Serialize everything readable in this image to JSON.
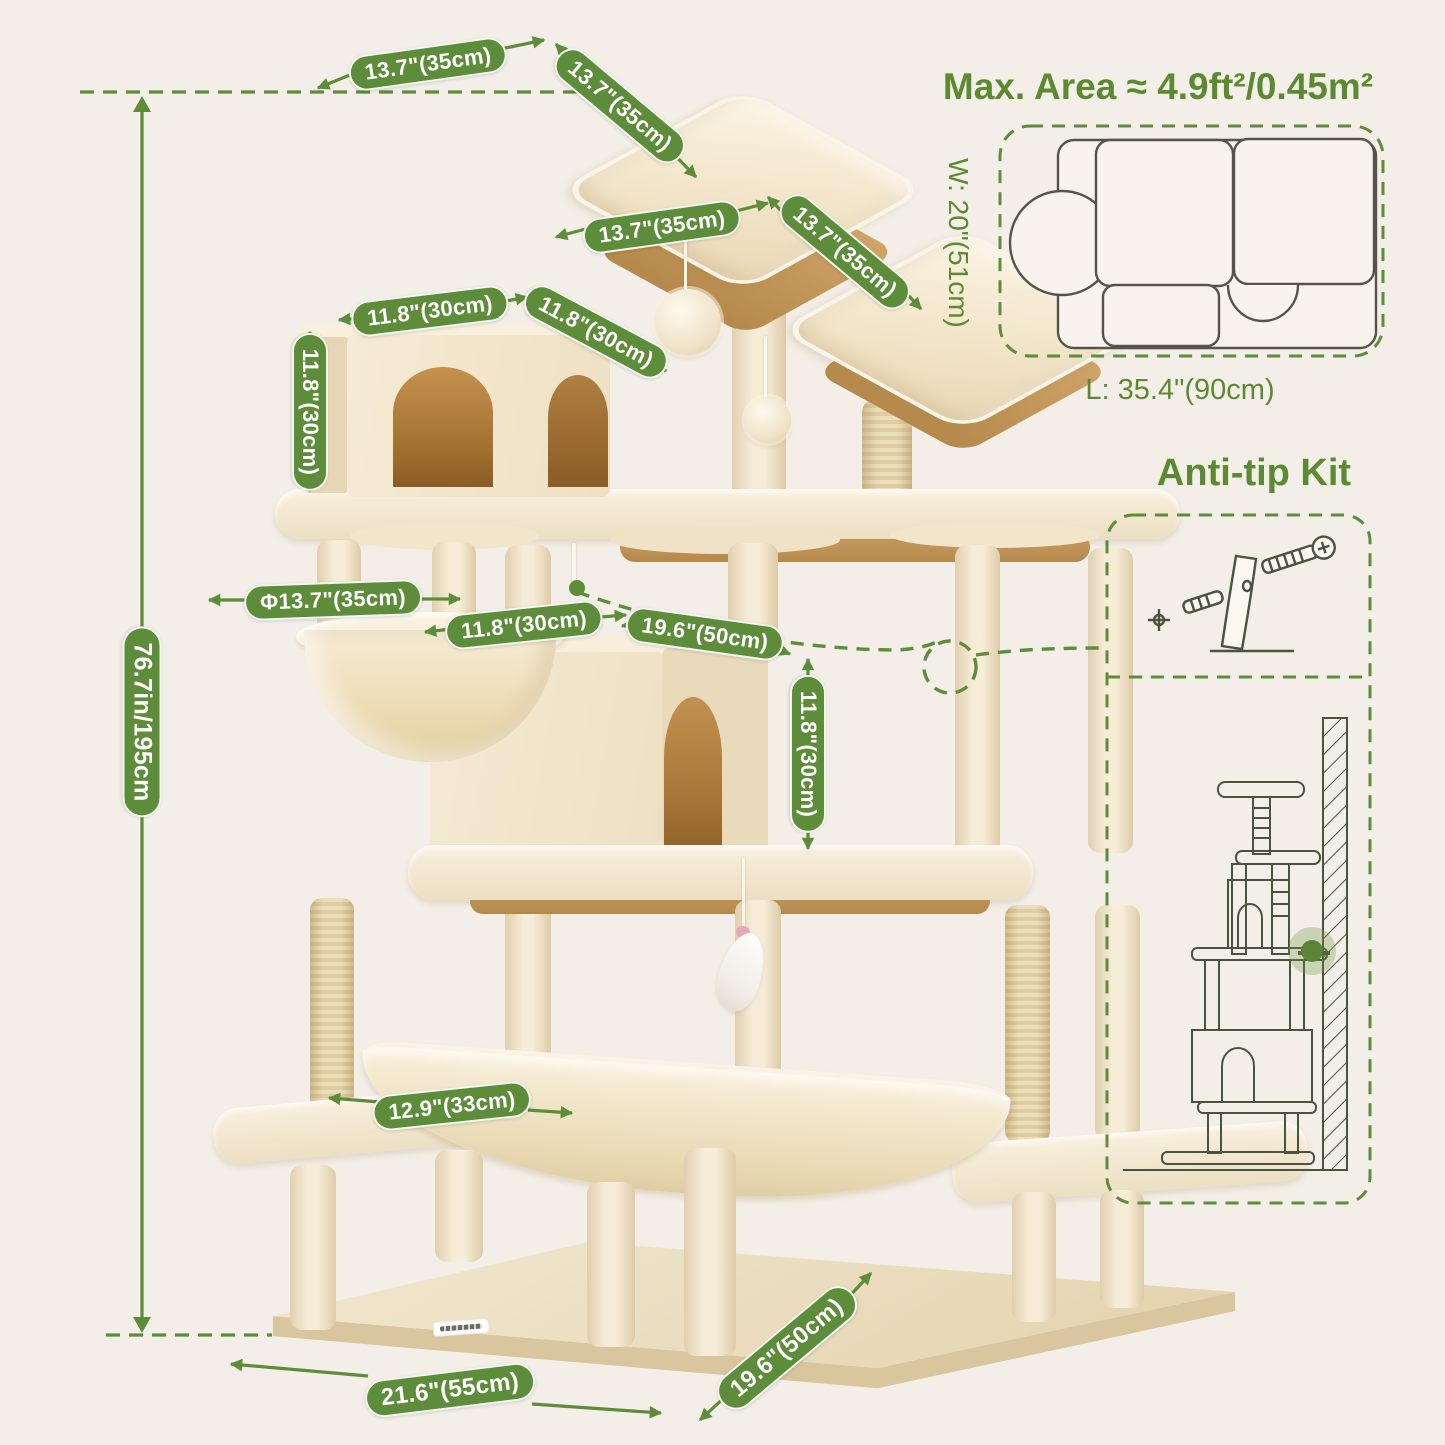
{
  "colors": {
    "background": "#f3eee7",
    "accent_green": "#5d8c3a",
    "title_green": "#5b8a33",
    "tree_cream": "#f2e7d1",
    "wood_tan": "#bf9355",
    "line_drawing": "#4a5240"
  },
  "annotations": {
    "height": "76.7in/195cm",
    "top_perch_width": "13.7\"(35cm)",
    "top_perch_depth": "13.7\"(35cm)",
    "upper_perch_width": "13.7\"(35cm)",
    "upper_perch_depth": "13.7\"(35cm)",
    "top_condo_width": "11.8\"(30cm)",
    "top_condo_depth": "11.8\"(30cm)",
    "top_condo_height": "11.8\"(30cm)",
    "basket_diameter": "Φ13.7\"(35cm)",
    "big_condo_width": "11.8\"(30cm)",
    "big_condo_length": "19.6\"(50cm)",
    "big_condo_height": "11.8\"(30cm)",
    "hammock_width": "12.9\"(33cm)",
    "base_length": "21.6\"(55cm)",
    "base_depth": "19.6\"(50cm)"
  },
  "max_area": {
    "title": "Max. Area ≈ 4.9ft²/0.45m²",
    "width_label": "W: 20\"(51cm)",
    "length_label": "L: 35.4\"(90cm)"
  },
  "anti_tip": {
    "title": "Anti-tip Kit"
  }
}
